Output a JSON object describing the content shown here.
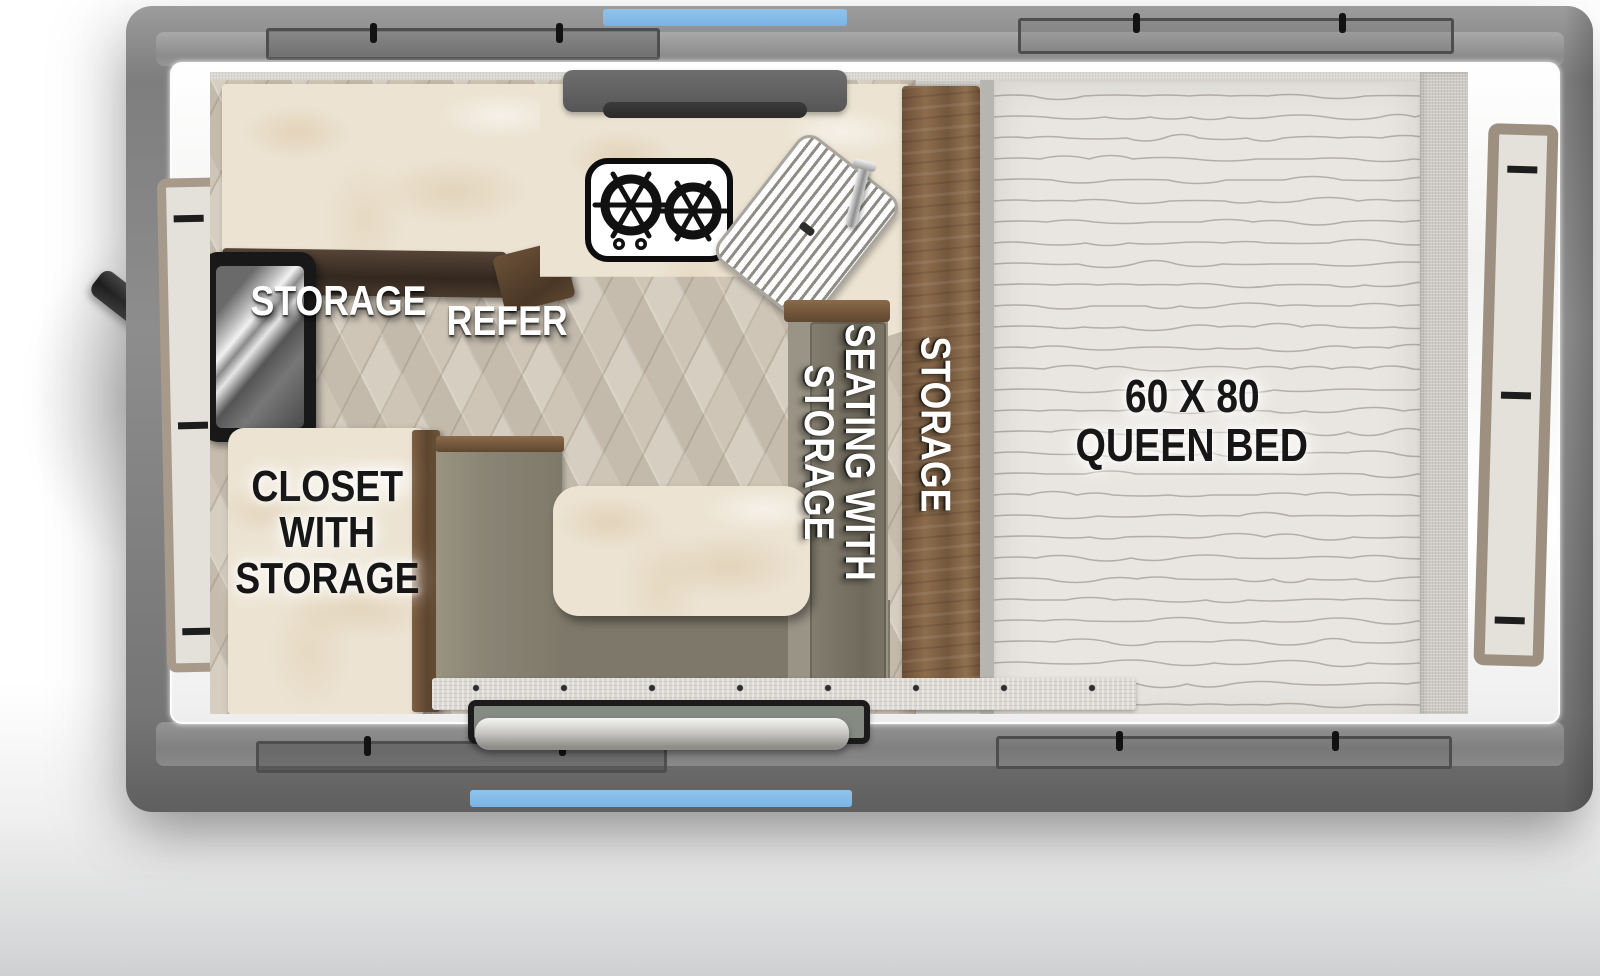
{
  "labels": {
    "storage_upper": "STORAGE",
    "refer": "REFER",
    "closet_line1": "CLOSET",
    "closet_line2": "WITH",
    "closet_line3": "STORAGE",
    "seating_line1": "SEATING WITH",
    "seating_line2": "STORAGE",
    "storage_side": "STORAGE",
    "bed_line1": "60 X 80",
    "bed_line2": "QUEEN BED"
  },
  "colors": {
    "accent_blue": "#7fb9e6",
    "shell_gray": "#7e7e7e",
    "wood_brown": "#7c5f43",
    "dark_wood": "#4a3a2d",
    "seat_olive": "#8a8476",
    "marble_cream": "#ece3d2",
    "mattress": "#e9e6e1",
    "label_white": "#ffffff",
    "label_black": "#161616"
  },
  "fixtures": {
    "stove_burner_count": 2
  }
}
